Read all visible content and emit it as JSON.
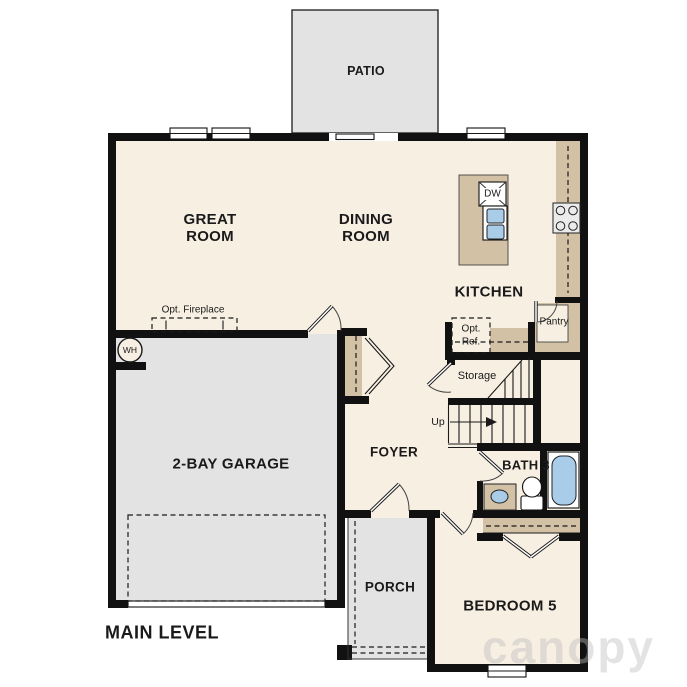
{
  "plan": {
    "title": "MAIN LEVEL",
    "watermark": "canopy",
    "rooms": {
      "patio": "PATIO",
      "great_room": "GREAT ROOM",
      "dining_room": "DINING ROOM",
      "kitchen": "KITCHEN",
      "pantry": "Pantry",
      "storage": "Storage",
      "garage": "2-BAY GARAGE",
      "foyer": "FOYER",
      "bath3": "BATH 3",
      "porch": "PORCH",
      "bedroom5": "BEDROOM 5"
    },
    "annotations": {
      "opt_fireplace": "Opt. Fireplace",
      "opt_ref_1": "Opt.",
      "opt_ref_2": "Ref.",
      "up": "Up",
      "wh": "WH",
      "dw": "DW"
    },
    "colors": {
      "wall": "#111111",
      "floor": "#f7efe2",
      "outdoor": "#e3e3e3",
      "counter": "#d2c1a5",
      "fixture_blue": "#a9cce9"
    }
  }
}
